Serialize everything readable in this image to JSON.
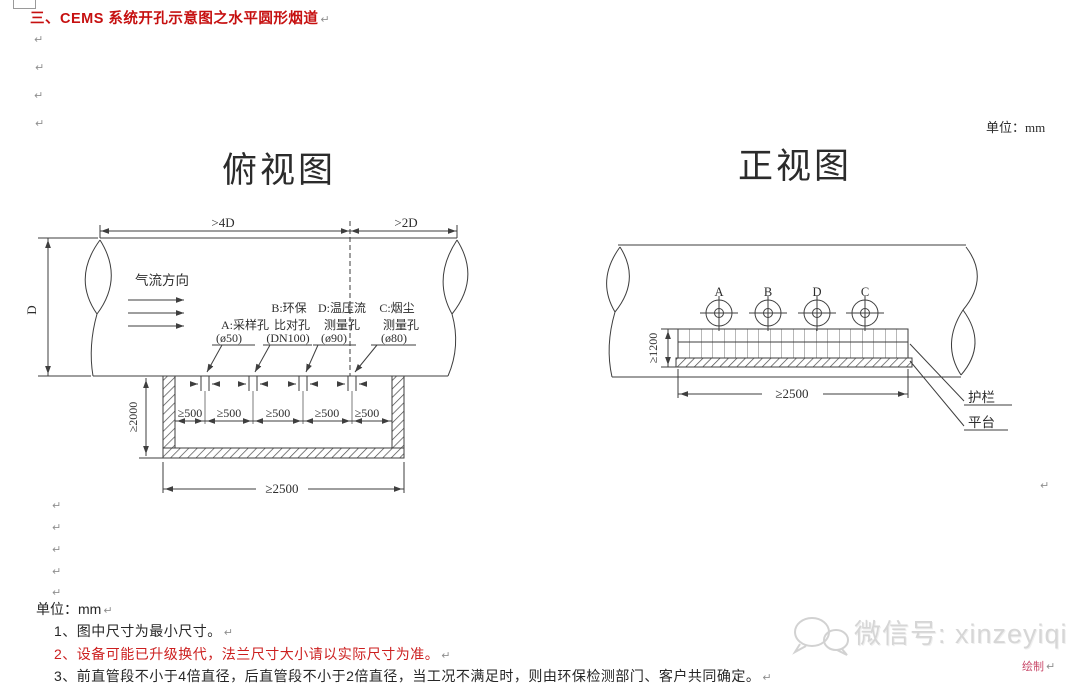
{
  "page": {
    "pilcrow": "↵"
  },
  "header": {
    "title": "三、CEMS 系统开孔示意图之水平圆形烟道",
    "unit_label": "单位：mm"
  },
  "top_view": {
    "title": "俯视图",
    "flow_label": "气流方向",
    "dims": {
      "upstream": ">4D",
      "downstream": ">2D",
      "duct_diameter": "D",
      "platform_depth": "≥2000",
      "hole_spacing": "≥500",
      "platform_width": "≥2500"
    },
    "holes": {
      "a": {
        "name": "A:采样孔",
        "size": "(ø50)"
      },
      "b": {
        "name": "B:环保",
        "name2": "比对孔",
        "size": "(DN100)"
      },
      "d": {
        "name": "D:温压流",
        "name2": "测量孔",
        "size": "(ø90)"
      },
      "c": {
        "name": "C:烟尘",
        "name2": "测量孔",
        "size": "(ø80)"
      }
    }
  },
  "front_view": {
    "title": "正视图",
    "hole_labels": {
      "a": "A",
      "b": "B",
      "d": "D",
      "c": "C"
    },
    "dims": {
      "railing_height": "≥1200",
      "platform_width": "≥2500"
    },
    "callouts": {
      "railing": "护栏",
      "platform": "平台"
    }
  },
  "notes": {
    "unit_label": "单位：mm",
    "note1": "1、图中尺寸为最小尺寸。",
    "note2": "2、设备可能已升级换代，法兰尺寸大小请以实际尺寸为准。",
    "note3": "3、前直管段不小于4倍直径，后直管段不小于2倍直径，当工况不满足时，则由环保检测部门、客户共同确定。"
  },
  "watermark": {
    "wechat_label": "微信号: xinzeyiqi"
  },
  "footer": {
    "draft_label": "绘制"
  }
}
